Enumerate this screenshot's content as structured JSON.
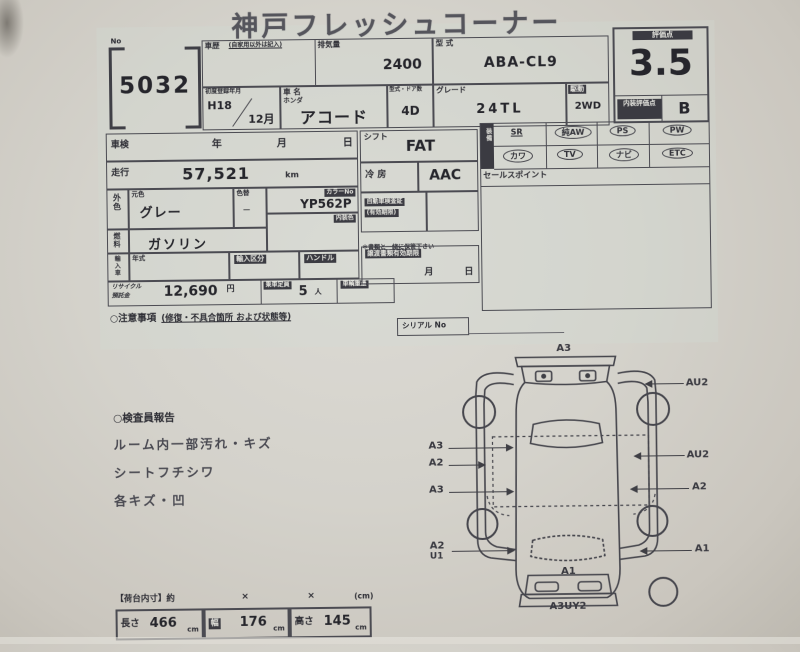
{
  "title": "神戸フレッシュコーナー",
  "lot": {
    "label": "No",
    "number": "5032"
  },
  "top": {
    "history_label": "車歴",
    "history_note": "(自家用以外は記入)",
    "displacement_label": "排気量",
    "displacement": "2400",
    "model_code_label": "型 式",
    "model_code": "ABA-CL9",
    "first_reg_label": "初度登録年月",
    "first_reg_year": "H18",
    "first_reg_month": "12月",
    "name_label": "車 名",
    "maker": "ホンダ",
    "car_name": "アコード",
    "doors_label": "型式・ドア数",
    "doors": "4D",
    "grade_label": "グレード",
    "grade": "24TL",
    "drive_label": "駆動",
    "drive": "2WD"
  },
  "rating": {
    "score_label": "評価点",
    "score": "3.5",
    "interior_label": "内装評価点",
    "interior": "B"
  },
  "left": {
    "shaken_label": "車検",
    "year": "年",
    "month": "月",
    "day": "日",
    "mileage_label": "走行",
    "mileage": "57,521",
    "mileage_unit": "km",
    "ext_color_label": "外色",
    "base_color_label": "元色",
    "base_color": "グレー",
    "color_change_label": "色替",
    "color_change": "ー",
    "color_no_label": "カラーNo",
    "color_no": "YP562P",
    "interior_color_label": "内装色",
    "fuel_label": "燃料",
    "fuel": "ガソリン",
    "import_label": "輸入車",
    "import_year_label": "年式",
    "import_type_label": "輸入区分",
    "handle_label": "ハンドル",
    "recycle_label1": "リサイクル",
    "recycle_label2": "預託金",
    "recycle_fee": "12,690",
    "yen": "円",
    "capacity_label": "乗車定員",
    "capacity": "5",
    "capacity_unit": "人",
    "weight_label": "車輌重量",
    "notes_label": "○注意事項",
    "notes_note": "(修復・不具合箇所 および状態等)"
  },
  "middle": {
    "shift_label": "シフト",
    "shift": "FAT",
    "ac_label": "冷 房",
    "ac": "AAC",
    "doc_label1": "自動車検査証",
    "doc_label2": "(有効期限)",
    "doc_note": "＊書類と一緒に保管下さい",
    "transfer_label": "譲渡書類有効期限",
    "month": "月",
    "day": "日"
  },
  "equipment": {
    "label": "装備",
    "row1": [
      "SR",
      "純AW",
      "PS",
      "PW"
    ],
    "row2": [
      "カワ",
      "TV",
      "ナビ",
      "ETC"
    ],
    "sales_label": "セールスポイント"
  },
  "serial": {
    "label": "シリアル No"
  },
  "inspector": {
    "title": "○検査員報告",
    "lines": [
      "ルーム内一部汚れ・キズ",
      "シートフチシワ",
      "各キズ・凹"
    ]
  },
  "diagram": {
    "top": "A3",
    "left1": "A3",
    "left2": "A2",
    "left3": "A3",
    "left4a": "A2",
    "left4b": "U1",
    "right1": "AU2",
    "right2": "AU2",
    "right3": "A2",
    "right4": "A1",
    "inside": "A1",
    "bottom": "A3UY2"
  },
  "dims": {
    "title": "【荷台内寸】約",
    "x1": "×",
    "x2": "×",
    "cm_note": "(cm)",
    "length_label": "長さ",
    "length": "466",
    "width_label": "幅",
    "width": "176",
    "height_label": "高さ",
    "height": "145",
    "unit": "cm"
  }
}
